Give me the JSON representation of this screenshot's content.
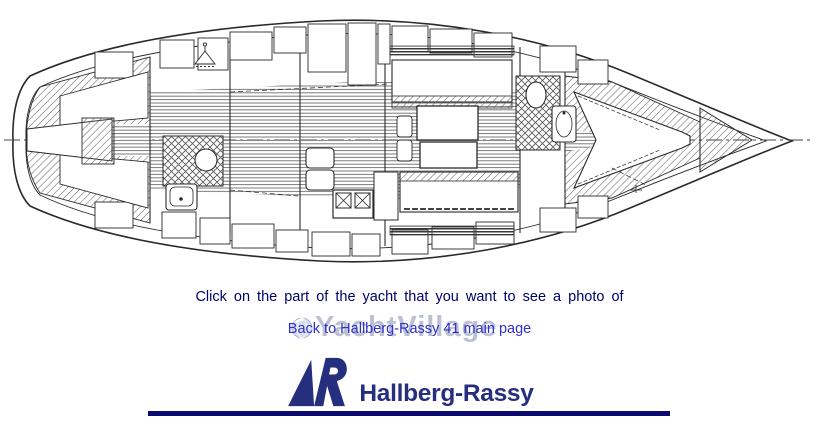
{
  "figure": {
    "alt": "Hallberg-Rassy 41 interior layout plan drawing, bow to the right",
    "ink_color": "#2a2a2a",
    "clickable_parts": [
      "aft-cabin",
      "aft-head",
      "galley",
      "saloon",
      "forward-head",
      "forward-cabin"
    ]
  },
  "instruction": {
    "text": "Click on the part of the yacht that you want to see a photo of",
    "color": "#00006b"
  },
  "back_link": {
    "text": "Back to Hallberg-Rassy 41 main page",
    "color": "#3030cf"
  },
  "watermark": {
    "text": "YachtVillage",
    "color": "#bcc1d2",
    "icon": "globe-icon"
  },
  "logo": {
    "text": "Hallberg-Rassy",
    "color": "#252f7d",
    "mark": "sail-r-emblem"
  },
  "footer": {
    "divider_color": "#0a0a70"
  }
}
